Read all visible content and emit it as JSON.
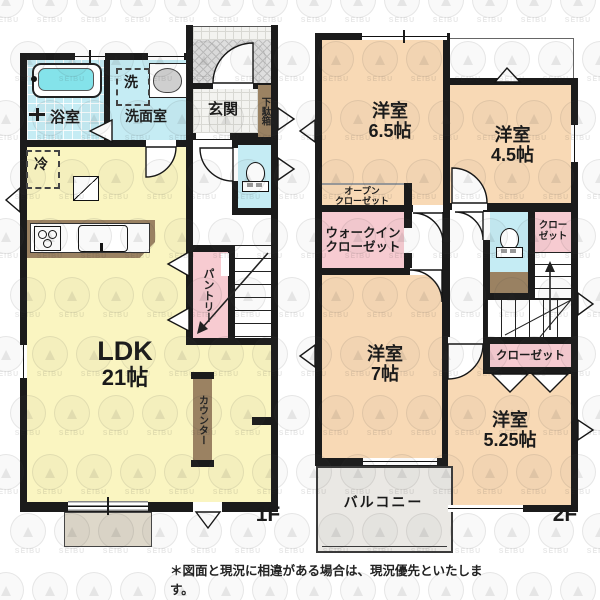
{
  "watermark": {
    "text": "SEIBU"
  },
  "colors": {
    "wall": "#1b1b1b",
    "ldk_yellow": "#faf5c1",
    "room_peach": "#f8d9b5",
    "closet_pink": "#f7cbd1",
    "wet_cyan": "#c5ecf4",
    "bathtub_cyan": "#84e3ea",
    "wood_brown": "#9b8262",
    "balcony_gray": "#eae8e4"
  },
  "floor1": {
    "label": "1F",
    "bath": "浴室",
    "washer": "洗",
    "washroom": "洗面室",
    "entrance": "玄関",
    "shoe_cabinet": "下駄箱",
    "fridge": "冷",
    "ldk_name": "LDK",
    "ldk_size": "21帖",
    "pantry": "パントリー",
    "counter": "カウンター"
  },
  "floor2": {
    "label": "2F",
    "room65_name": "洋室",
    "room65_size": "6.5帖",
    "room45_name": "洋室",
    "room45_size": "4.5帖",
    "open_closet_l1": "オープン",
    "open_closet_l2": "クローゼット",
    "wic_l1": "ウォークイン",
    "wic_l2": "クローゼット",
    "closet_l1": "クロー",
    "closet_l2": "ゼット",
    "closet_wide": "クローゼット",
    "room7_name": "洋室",
    "room7_size": "7帖",
    "room525_name": "洋室",
    "room525_size": "5.25帖",
    "balcony": "バルコニー"
  },
  "footer": {
    "disclaimer": "＊図面と現況に相違がある場合は、現況優先といたします。"
  }
}
